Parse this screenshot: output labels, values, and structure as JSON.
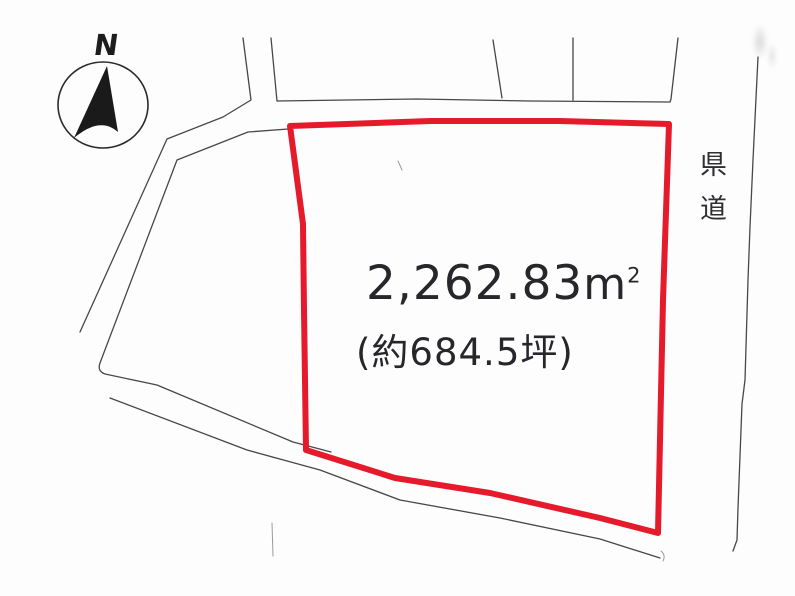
{
  "compass": {
    "label": "N"
  },
  "plot": {
    "area_value": "2,262.83",
    "area_unit": "m",
    "area_exponent": "2",
    "area_tsubo": "(約684.5坪)"
  },
  "road": {
    "label": "県道"
  },
  "colors": {
    "plot_outline": "#e51a2b",
    "boundary": "#474747",
    "faint_mark": "#9a9a9a",
    "compass": "#1a1a1a",
    "compass_ring": "#2b2b2b"
  }
}
